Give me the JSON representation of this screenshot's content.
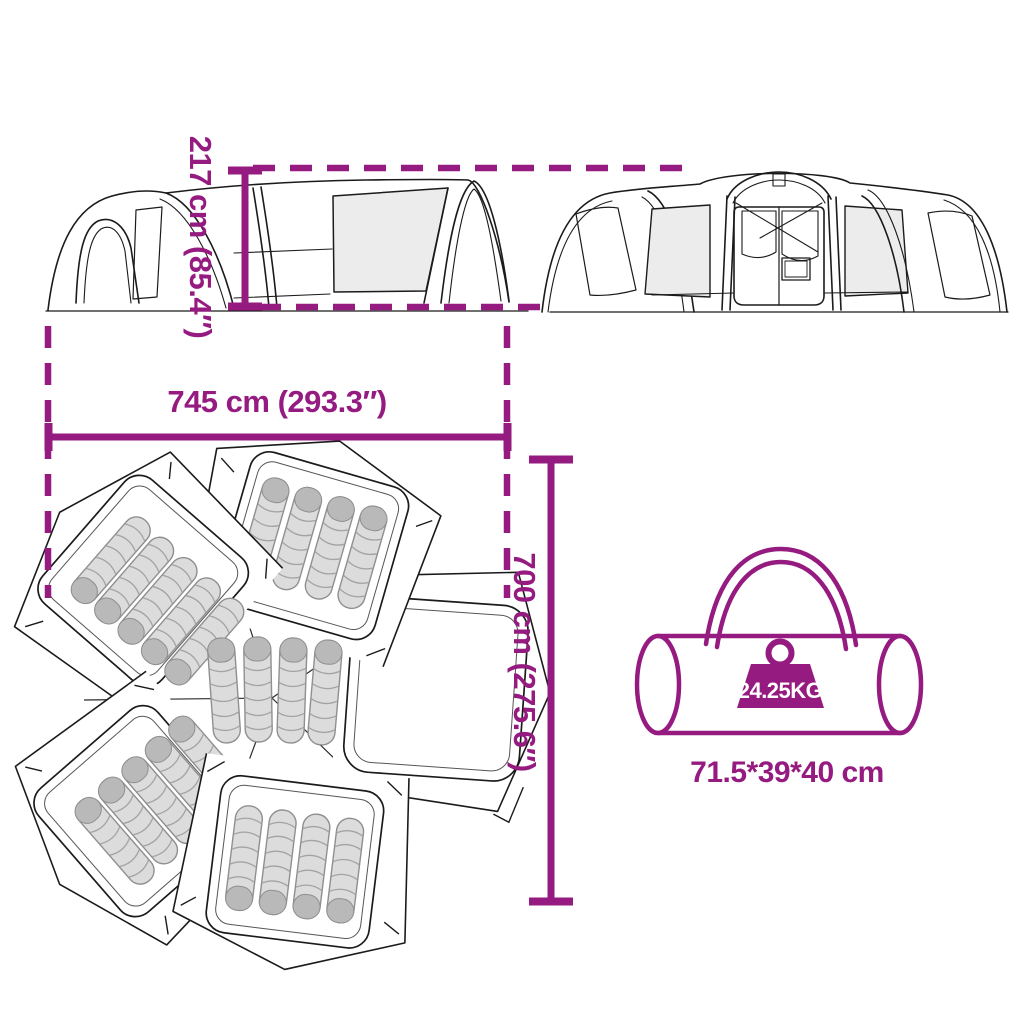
{
  "colors": {
    "accent": "#951B81",
    "line": "#1b1b1b",
    "panel_gray": "#ececec",
    "bag_gray": "#dcdcdc",
    "background": "#ffffff"
  },
  "labels": {
    "height": "217 cm (85.4″)",
    "width": "745 cm (293.3″)",
    "depth": "700 cm (275.6″)",
    "carry_bag_size": "71.5*39*40 cm",
    "weight": "24.25KG"
  },
  "figures": {
    "side_view_icon": "tent-side-view-line-art",
    "front_view_icon": "tent-front-view-line-art",
    "top_view_icon": "tent-floorplan-top-view-with-sleeping-bags",
    "carry_bag_icon": "duffel-carry-bag-line-art",
    "weight_icon": "weight-badge"
  }
}
